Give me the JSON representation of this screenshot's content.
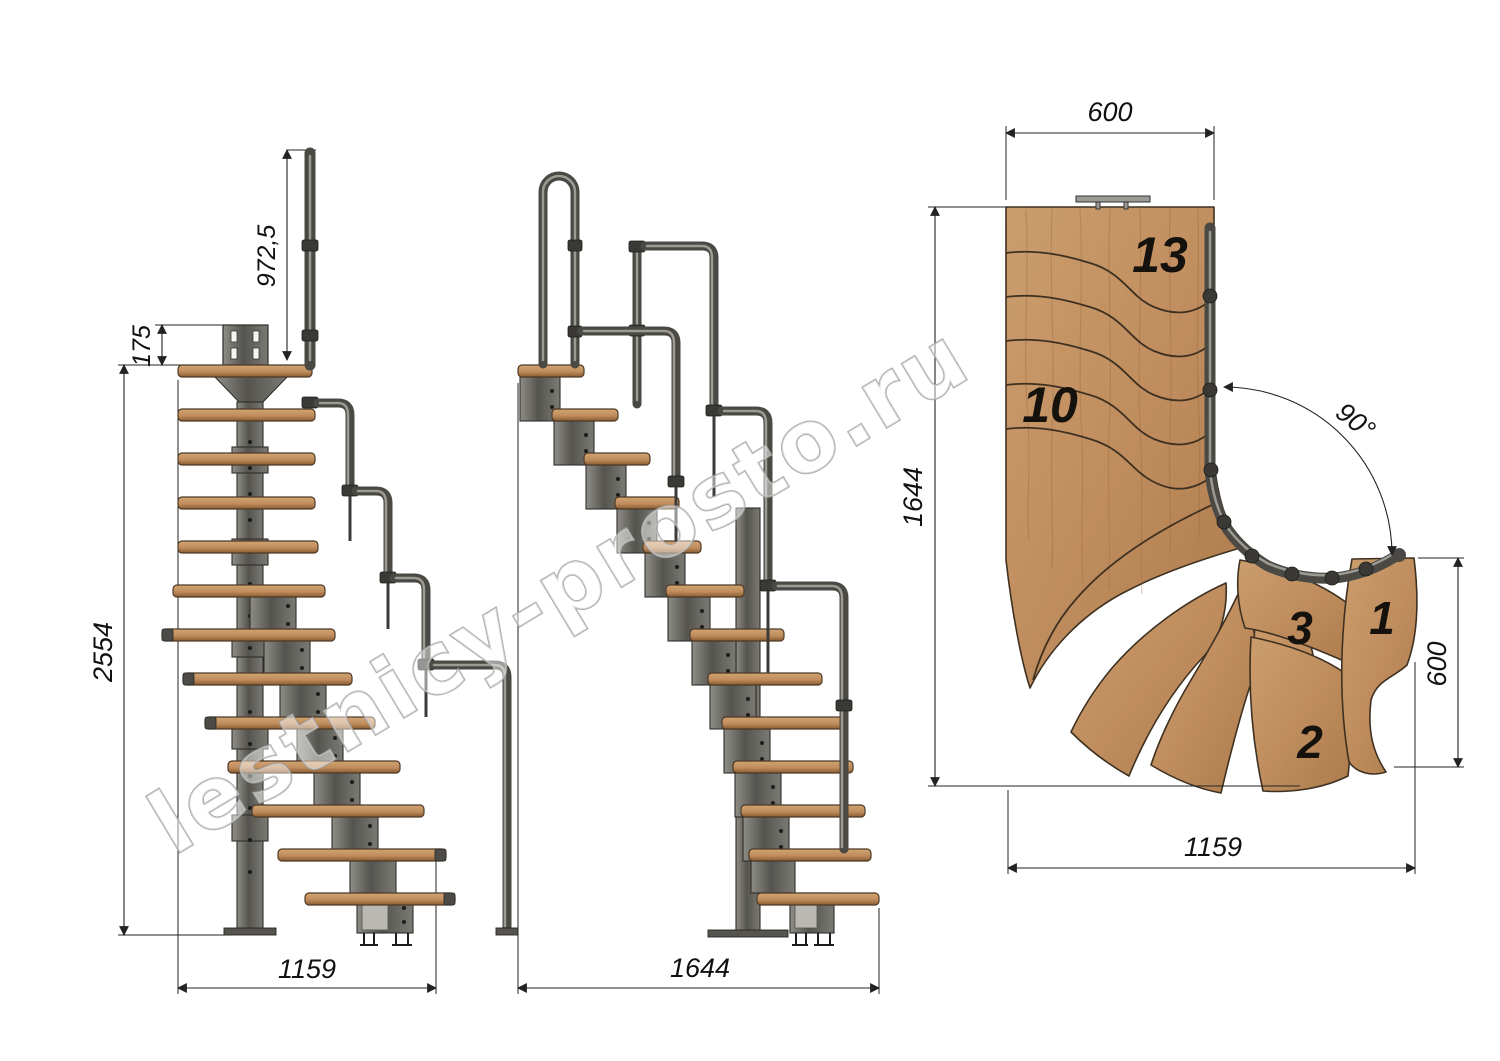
{
  "watermark": {
    "text": "lestnicy-prosto.ru"
  },
  "views": {
    "front": {
      "title": "front elevation",
      "dims": {
        "handrail_height": "972,5",
        "mount_plate": "175",
        "total_height": "2554",
        "footprint_width": "1159"
      }
    },
    "side": {
      "title": "side elevation",
      "dims": {
        "footprint_depth": "1644"
      }
    },
    "plan": {
      "title": "plan view",
      "dims": {
        "upper_flight_width": "600",
        "plan_depth": "1644",
        "lower_flight_width": "600",
        "plan_width": "1159",
        "turn_angle": "90°"
      },
      "steps": {
        "top": "13",
        "mid": "10",
        "three": "3",
        "two": "2",
        "one": "1"
      }
    }
  },
  "colors": {
    "wood_light": "#d2a372",
    "wood": "#c08d5e",
    "wood_dark": "#8a5c32",
    "metal": "#55544f",
    "metal_light": "#8e8d87",
    "outline": "#2e2d29",
    "dim_line": "#232323",
    "watermark_stroke": "#9f9f9f"
  }
}
